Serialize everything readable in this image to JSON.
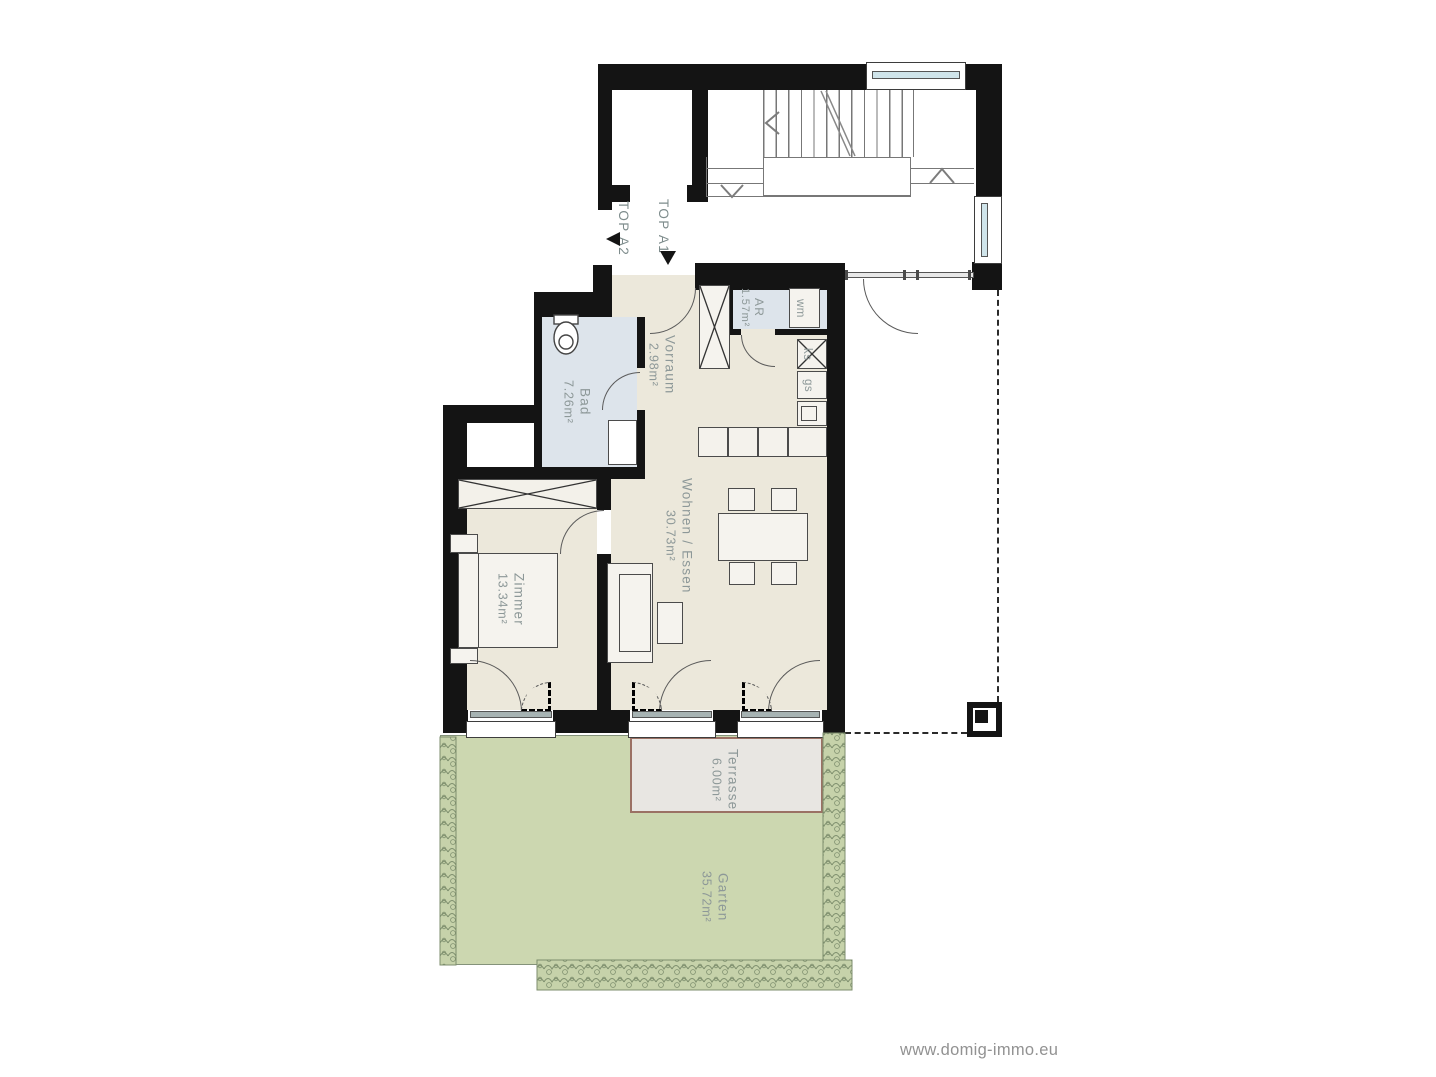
{
  "watermark": "www.domig-immo.eu",
  "units": {
    "a1": "TOP A1",
    "a2": "TOP A2"
  },
  "rooms": {
    "vorraum": {
      "name": "Vorraum",
      "area": "2.98m²"
    },
    "ar": {
      "name": "AR",
      "area": "1.57m²"
    },
    "bad": {
      "name": "Bad",
      "area": "7.26m²"
    },
    "zimmer": {
      "name": "Zimmer",
      "area": "13.34m²"
    },
    "wohnen": {
      "name": "Wohnen / Essen",
      "area": "30.73m²"
    },
    "terrasse": {
      "name": "Terrasse",
      "area": "6.00m²"
    },
    "garten": {
      "name": "Garten",
      "area": "35.72m²"
    }
  },
  "appliances": {
    "wm": "wm",
    "ks": "ks",
    "gs": "gs"
  },
  "colors": {
    "wall": "#141414",
    "floor": "#ece8db",
    "wet": "#dde4eb",
    "garden": "#ccd7b0",
    "terrace": "#e8e6e2",
    "label": "#8d9898"
  }
}
